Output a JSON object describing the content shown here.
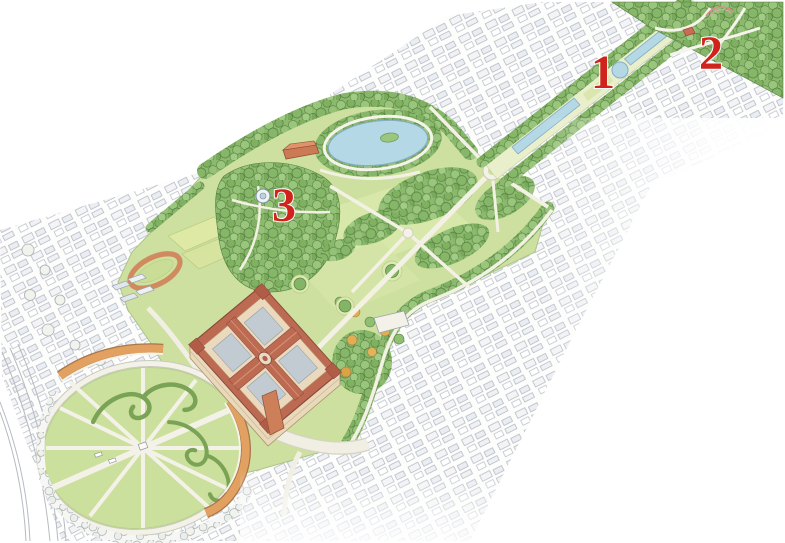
{
  "markers": [
    {
      "label": "1"
    },
    {
      "label": "2"
    },
    {
      "label": "3"
    }
  ],
  "palette": {
    "marker_red": "#cf231c",
    "lawn_green": "#cde09f",
    "bright_lawn": "#d8e8ab",
    "tree_green": "#8bb96d",
    "tree_dark": "#567f41",
    "water_blue": "#b4d8e5",
    "palace_roof": "#bd6a52",
    "palace_wall": "#ead9bd",
    "courtyard_gray": "#c2cbd2",
    "crescent_roof": "#e2a160",
    "track_terracotta": "#d18a5e",
    "city_line_gray": "#aab0bc",
    "path_cream": "#f3f1e4"
  }
}
